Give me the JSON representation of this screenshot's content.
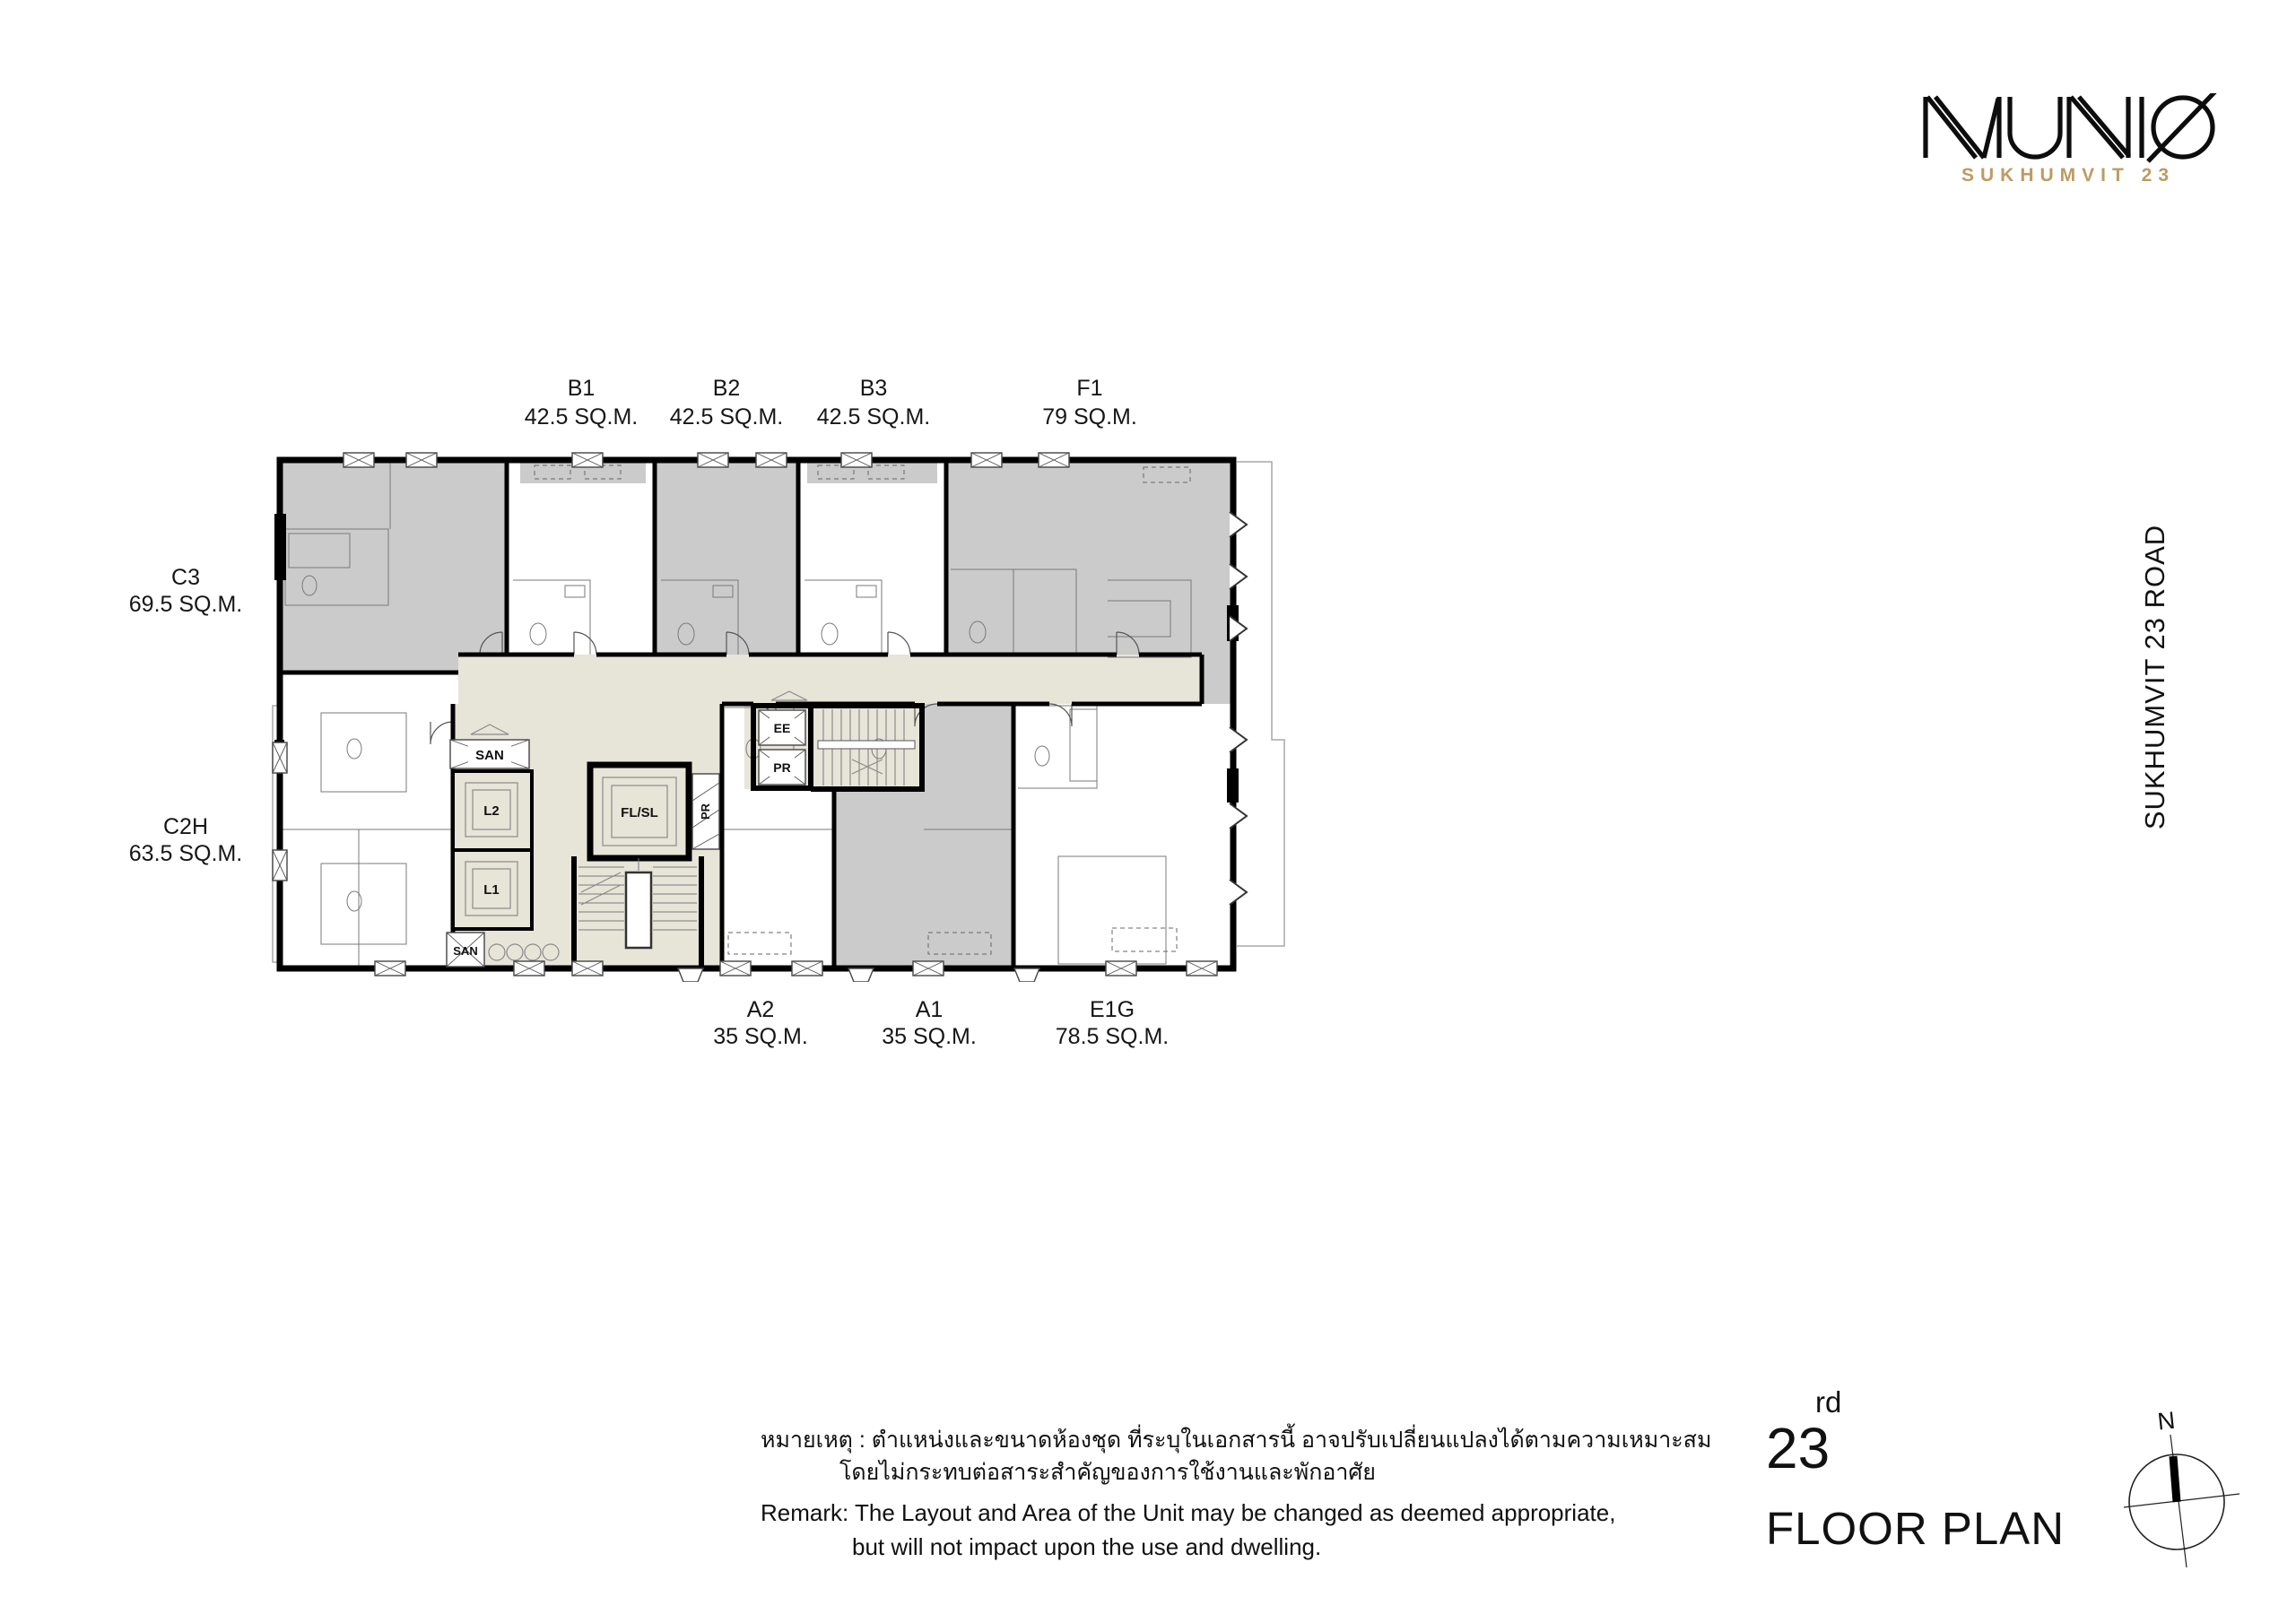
{
  "brand": {
    "wordmark": "MUNIQ",
    "tagline": "SUKHUMVIT 23"
  },
  "road_label": "SUKHUMVIT 23 ROAD",
  "units": {
    "top": [
      {
        "name": "B1",
        "area": "42.5 SQ.M."
      },
      {
        "name": "B2",
        "area": "42.5 SQ.M."
      },
      {
        "name": "B3",
        "area": "42.5 SQ.M."
      },
      {
        "name": "F1",
        "area": "79 SQ.M."
      }
    ],
    "left": [
      {
        "name": "C3",
        "area": "69.5 SQ.M."
      },
      {
        "name": "C2H",
        "area": "63.5 SQ.M."
      }
    ],
    "bottom": [
      {
        "name": "A2",
        "area": "35 SQ.M."
      },
      {
        "name": "A1",
        "area": "35 SQ.M."
      },
      {
        "name": "E1G",
        "area": "78.5 SQ.M."
      }
    ]
  },
  "plan_core": {
    "san_top": "SAN",
    "lift_l2": "L2",
    "lift_l1": "L1",
    "lift_flsl": "FL/SL",
    "pr_shaft_side": "PR",
    "ee_shaft": "EE",
    "pr_shaft": "PR",
    "san_bottom": "SAN"
  },
  "remark": {
    "thai_line1": "หมายเหตุ : ตำแหน่งและขนาดห้องชุด ที่ระบุในเอกสารนี้ อาจปรับเปลี่ยนแปลงได้ตามความเหมาะสม",
    "thai_line2": "โดยไม่กระทบต่อสาระสำคัญของการใช้งานและพักอาศัย",
    "en_line1": "Remark: The Layout and Area of the Unit may be changed as deemed appropriate,",
    "en_line2": "but will not impact upon the use and dwelling."
  },
  "floor_title": {
    "number": "23",
    "ordinal": "rd",
    "label": "FLOOR PLAN"
  },
  "compass": {
    "north": "N"
  },
  "colors": {
    "accent_gold": "#bd9b63",
    "unit_gray": "#cbcbcb",
    "corridor_beige": "#e7e4d8",
    "wall_black": "#000000"
  }
}
